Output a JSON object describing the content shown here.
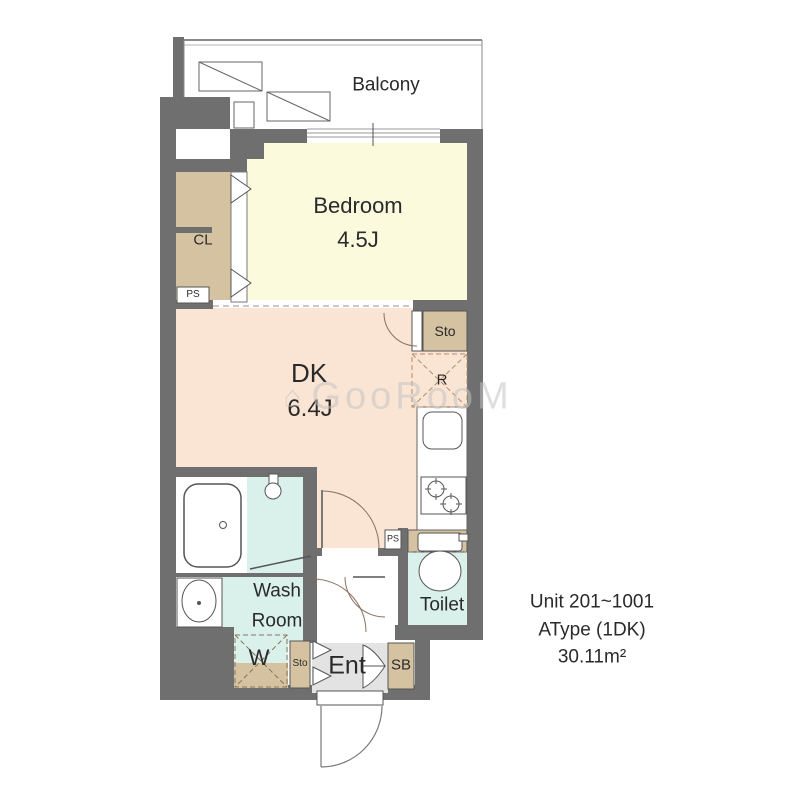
{
  "watermark": {
    "icon": "⌂",
    "text": "GooRooM"
  },
  "rooms": {
    "balcony": {
      "label": "Balcony"
    },
    "bedroom": {
      "label": "Bedroom",
      "size": "4.5J"
    },
    "dk": {
      "label": "DK",
      "size": "6.4J"
    },
    "washroom": {
      "line1": "Wash",
      "line2": "Room"
    },
    "toilet": {
      "label": "Toilet"
    },
    "entrance": {
      "label": "Ent"
    }
  },
  "storage": {
    "cl": "CL",
    "sto_upper": "Sto",
    "sto_lower": "Sto",
    "sb": "SB",
    "washer": "W",
    "fridge": "R",
    "ps_upper": "PS",
    "ps_lower": "PS"
  },
  "unit_info": {
    "line1": "Unit 201~1001",
    "line2": "AType (1DK)",
    "line3": "30.11m²"
  },
  "colors": {
    "wall": "#6f6f6f",
    "bedroom_floor": "#fbfadd",
    "dk_floor": "#fae4d3",
    "closet": "#d5c2a1",
    "wet_floor": "#daf0ea",
    "entrance_floor": "#e3e3e3"
  }
}
